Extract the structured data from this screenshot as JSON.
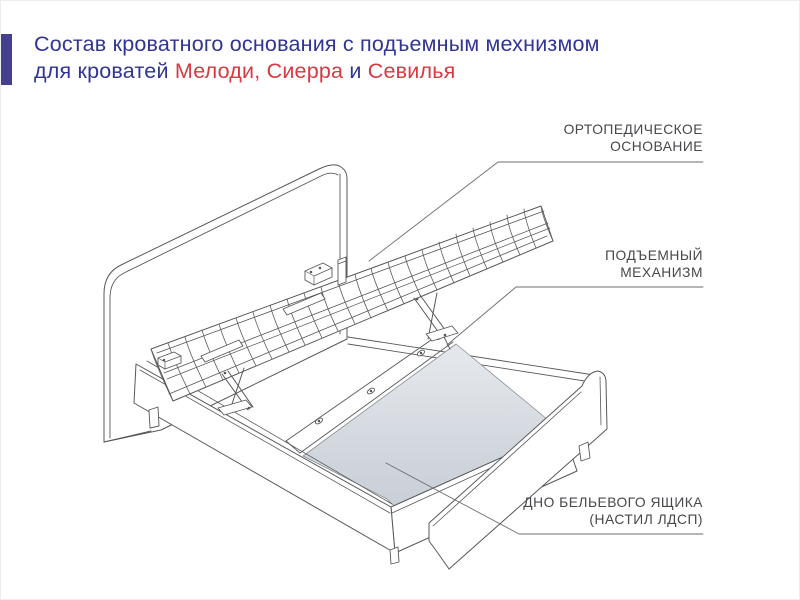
{
  "page": {
    "background": "#ffffff",
    "border_color": "#ededed"
  },
  "header": {
    "accent_bar_color": "#443f8e",
    "title_color": "#303494",
    "highlight_color": "#d63940",
    "line1": "Состав кроватного основания с подъемным мехнизмом",
    "line2_parts": [
      {
        "text": "для кроватей ",
        "highlight": false
      },
      {
        "text": "Мелоди, Сиерра",
        "highlight": true
      },
      {
        "text": " и ",
        "highlight": false
      },
      {
        "text": "Севилья",
        "highlight": true
      }
    ]
  },
  "diagram": {
    "line_color": "#55585b",
    "leader_color": "#6b6e71",
    "label_color": "#46484b",
    "ldsp_panel_gradient_start": "#e3e7eb",
    "ldsp_panel_gradient_end": "#c7cdd5",
    "labels": {
      "orthopedic_base": {
        "line1": "ОРТОПЕДИЧЕСКОЕ",
        "line2": "ОСНОВАНИЕ"
      },
      "lift_mechanism": {
        "line1": "ПОДЪЕМНЫЙ",
        "line2": "МЕХАНИЗМ"
      },
      "drawer_bottom": {
        "line1": "ДНО БЕЛЬЕВОГО ЯЩИКА",
        "line2": "(НАСТИЛ ЛДСП)"
      }
    }
  }
}
